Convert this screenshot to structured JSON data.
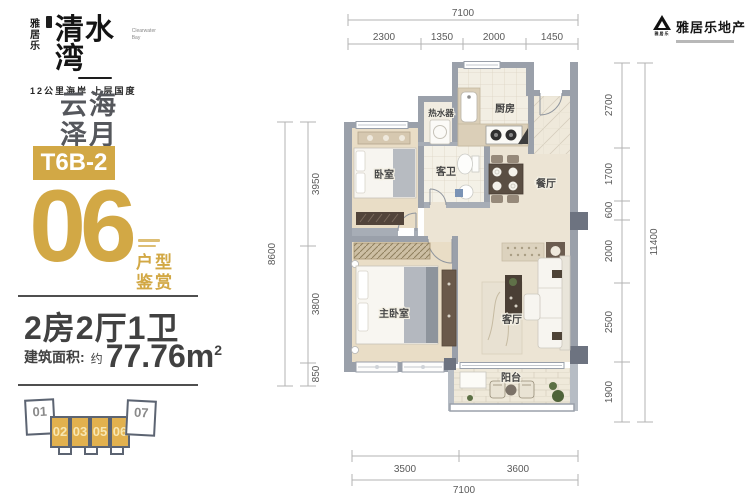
{
  "brand": {
    "logo_cn_vertical_1": "雅",
    "logo_cn_vertical_2": "居",
    "logo_cn_vertical_3": "乐",
    "logo_main": "清水湾",
    "logo_en": "Clearwater Bay",
    "logo_tagline": "12公里海岸 上层国度",
    "dev_logo_small": "雅居乐",
    "dev_name": "雅居乐地产"
  },
  "left_panel": {
    "zone_line1": "云海",
    "zone_line2": "泽月",
    "unit_code": "T6B-2",
    "unit_number": "06",
    "caption_line1": "户型",
    "caption_line2": "鉴赏",
    "layout_text": "2房2厅1卫",
    "area_label": "建筑面积:",
    "area_prefix": "约",
    "area_value": "77.76m",
    "area_sup": "2",
    "key_plan_units": [
      "01",
      "02",
      "03",
      "05",
      "06",
      "07"
    ]
  },
  "plan": {
    "rooms": {
      "water_heater": "热水器",
      "kitchen": "厨房",
      "bedroom": "卧室",
      "guest_bath": "客卫",
      "dining": "餐厅",
      "master_bedroom": "主卧室",
      "living": "客厅",
      "balcony": "阳台"
    },
    "dims": {
      "top_total": "7100",
      "top": [
        "2300",
        "1350",
        "2000",
        "1450"
      ],
      "bottom": [
        "3500",
        "3600"
      ],
      "bottom_total": "7100",
      "right": [
        "2700",
        "1700",
        "600",
        "2000",
        "2500",
        "1900"
      ],
      "right_total": "11400",
      "left": [
        "3950",
        "3800",
        "850"
      ],
      "left_total": "8600"
    }
  },
  "colors": {
    "gold": "#D2A845",
    "wall_gray": "#9AA0AA",
    "dark_text": "#414141"
  }
}
